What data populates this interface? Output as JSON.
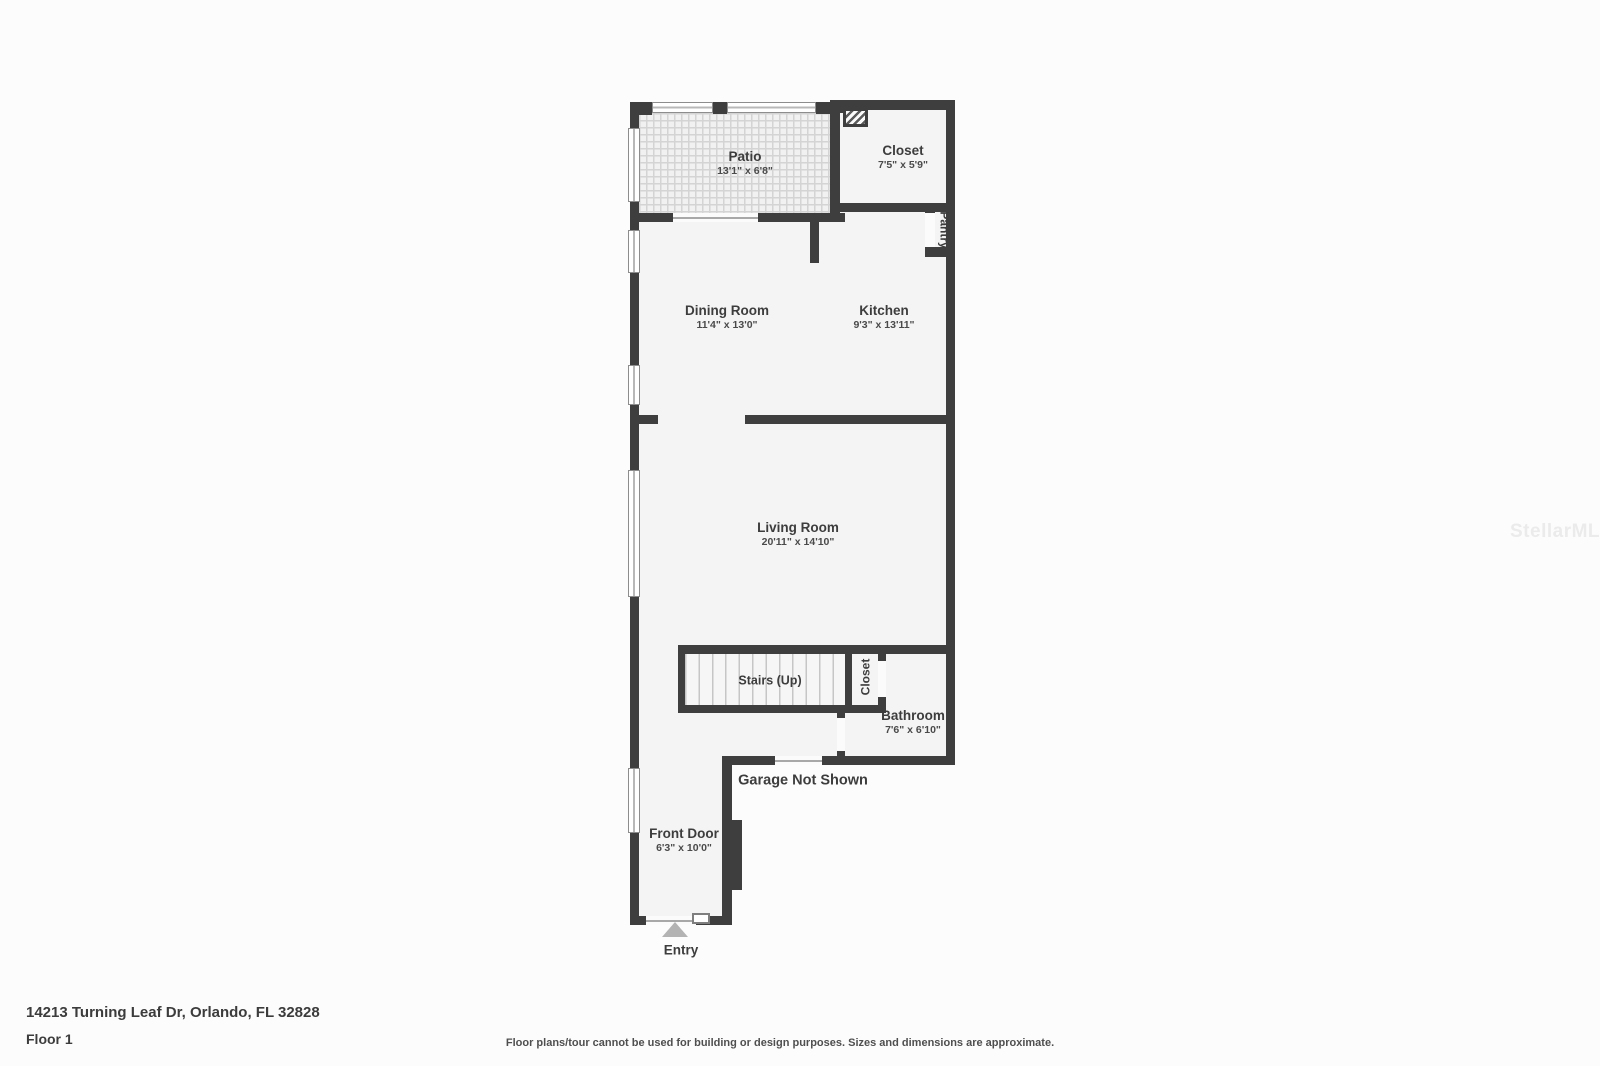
{
  "floorplan": {
    "rooms": {
      "patio": {
        "name": "Patio",
        "dims": "13'1\" x 6'8\""
      },
      "closet_top": {
        "name": "Closet",
        "dims": "7'5\" x 5'9\""
      },
      "pantry": {
        "name": "Pantry"
      },
      "dining": {
        "name": "Dining Room",
        "dims": "11'4\" x 13'0\""
      },
      "kitchen": {
        "name": "Kitchen",
        "dims": "9'3\" x 13'11\""
      },
      "living": {
        "name": "Living Room",
        "dims": "20'11\" x 14'10\""
      },
      "stairs": {
        "name": "Stairs (Up)"
      },
      "closet_hall": {
        "name": "Closet"
      },
      "bathroom": {
        "name": "Bathroom",
        "dims": "7'6\" x 6'10\""
      },
      "front_door": {
        "name": "Front Door",
        "dims": "6'3\" x 10'0\""
      }
    },
    "annotations": {
      "garage_note": "Garage Not Shown",
      "entry": "Entry"
    }
  },
  "footer": {
    "address": "14213 Turning Leaf Dr, Orlando, FL 32828",
    "floor_label": "Floor 1",
    "disclaimer": "Floor plans/tour cannot be used for building or design purposes. Sizes and dimensions are approximate."
  },
  "watermark": "StellarMLS",
  "colors": {
    "wall": "#3e3e3e",
    "room_fill": "#f4f4f4",
    "label_text": "#3d3d3d",
    "entry_arrow": "#b3b3b3"
  }
}
